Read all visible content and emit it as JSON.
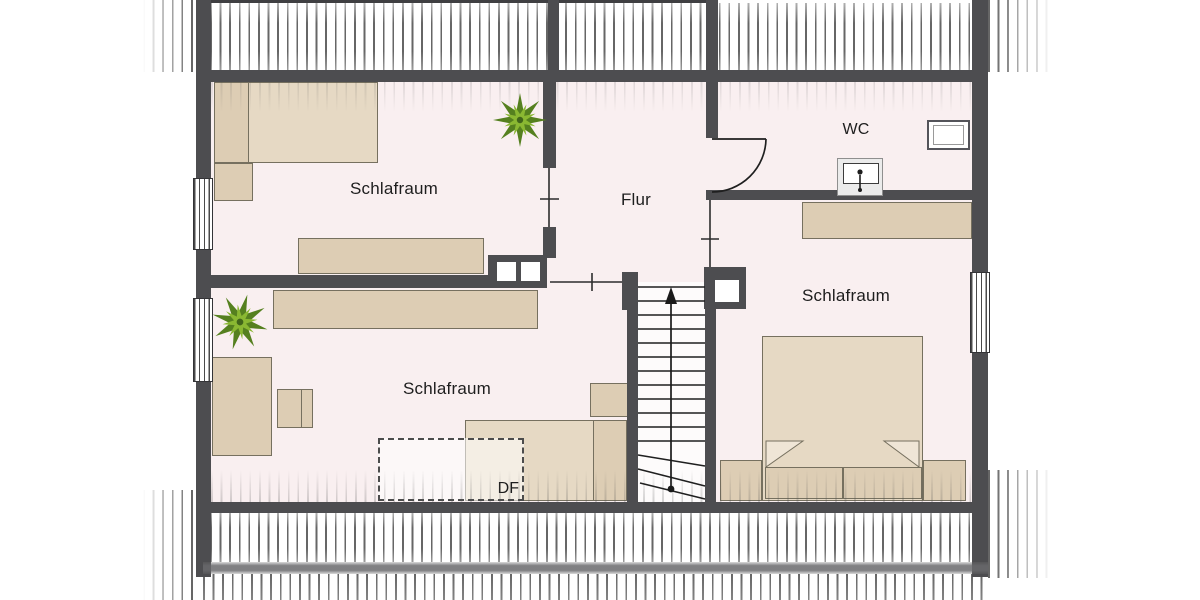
{
  "plan": {
    "rooms": {
      "bedroom_top_left": {
        "label": "Schlafraum"
      },
      "bedroom_bottom_left": {
        "label": "Schlafraum"
      },
      "bedroom_right": {
        "label": "Schlafraum"
      },
      "hallway": {
        "label": "Flur"
      },
      "wc": {
        "label": "WC"
      },
      "roof_window": {
        "label": "DF"
      }
    },
    "stairs": {
      "treads": 11,
      "direction": "up"
    },
    "colors": {
      "wall": "#4d4d50",
      "floor": "#f9eff0",
      "furniture": "#ddcdb4",
      "furniture_light": "#e6d9c4",
      "plant_dark": "#55801f",
      "plant_light": "#8ab832",
      "hatch": "#555555"
    }
  }
}
